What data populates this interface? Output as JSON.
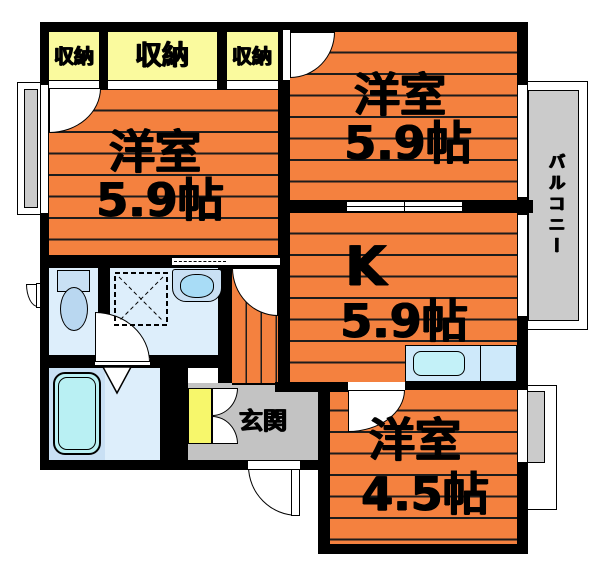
{
  "rooms": {
    "bedroom_left": {
      "name": "洋室",
      "size": "5.9帖"
    },
    "bedroom_top_right": {
      "name": "洋室",
      "size": "5.9帖"
    },
    "kitchen": {
      "name": "K",
      "size": "5.9帖"
    },
    "bedroom_bottom_right": {
      "name": "洋室",
      "size": "4.5帖"
    },
    "entrance": {
      "name": "玄関"
    },
    "balcony": {
      "name": "バルコニー"
    }
  },
  "closets": [
    {
      "label": "収納"
    },
    {
      "label": "収納"
    },
    {
      "label": "収納"
    }
  ],
  "colors": {
    "floor_orange": "#F4813F",
    "closet_yellow": "#FAFA9E",
    "shoe_cabinet_yellow": "#F7F76B",
    "wet_area_blue": "#DDEEFB",
    "fixture_blue": "#C9E0F4",
    "bathtub_cyan": "#B9F0F3",
    "entrance_gray": "#C3C3C3",
    "balcony_gray": "#CBCBCB",
    "wall_black": "#000000"
  }
}
